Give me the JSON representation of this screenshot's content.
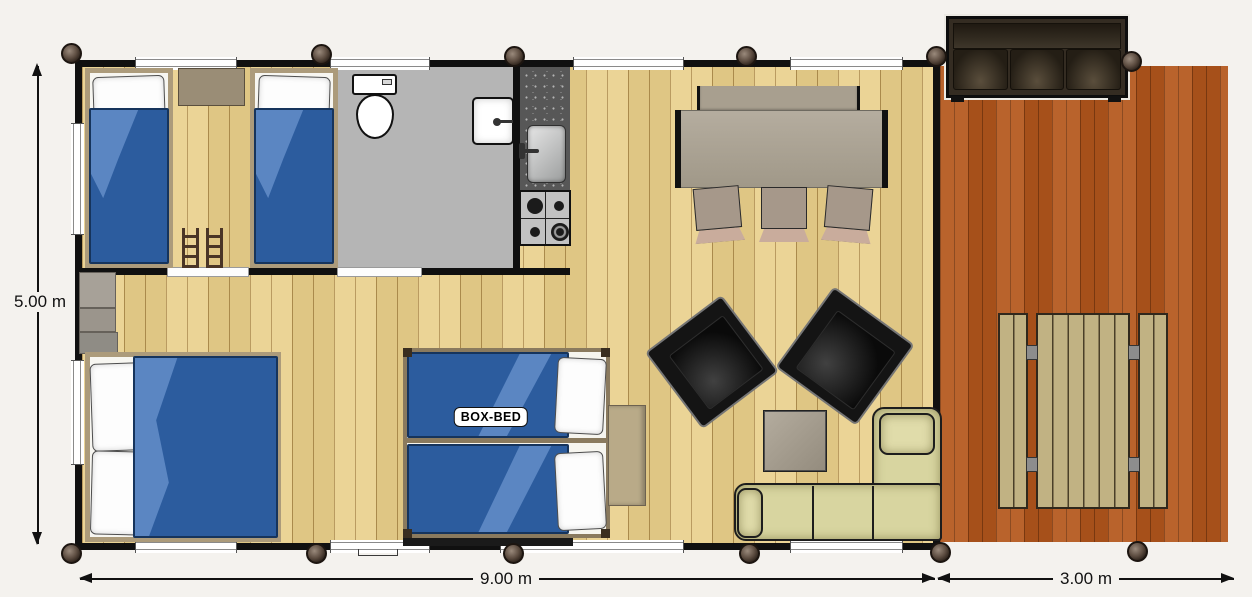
{
  "plan": {
    "box_bed_label": "BOX-BED",
    "dimensions": {
      "height": "5.00 m",
      "cabin_width": "9.00 m",
      "terrace_width": "3.00 m"
    },
    "colors": {
      "background": "#f4f2ee",
      "wall": "#101010",
      "floor_wood": "#e9cf8a",
      "terrace_wood": "#b4571c",
      "bathroom_floor": "#b5b5b5",
      "duvet_blue": "#2c5c9e",
      "duvet_fold_blue": "#5b86c2",
      "sofa_beige": "#d8d5a0",
      "armchair_black": "#141414",
      "counter_gray": "#575757",
      "picnic_wood": "#c1b283",
      "terrace_sofa_brown": "#342c22"
    }
  }
}
